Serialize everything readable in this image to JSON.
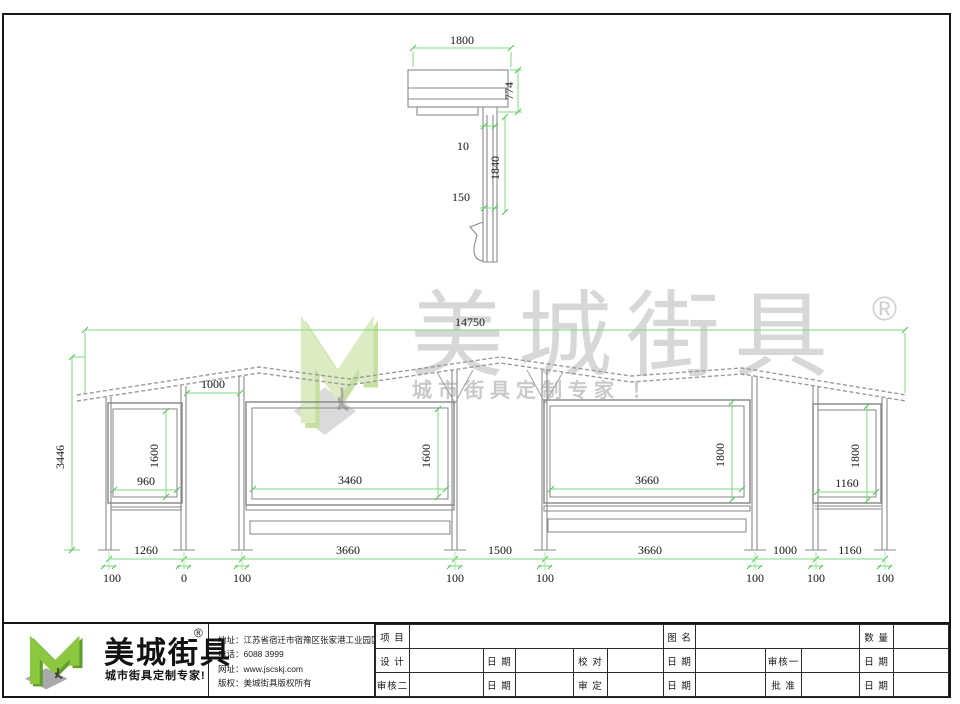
{
  "side_view": {
    "width": "1800",
    "roof_depth": "774",
    "gap": "10",
    "post_length": "1840",
    "offset": "150"
  },
  "elevation": {
    "total_width": "14750",
    "total_height": "3446",
    "roof_gap": "1000",
    "panel_a_width": "960",
    "panel_a_height": "1600",
    "panel_b_width": "3460",
    "panel_b_height": "1600",
    "panel_c_width": "3660",
    "panel_c_height": "1800",
    "panel_d_width": "1160",
    "panel_d_height": "1800",
    "spans": [
      "1260",
      "3660",
      "1500",
      "3660",
      "1000",
      "1160"
    ],
    "offsets": [
      "100",
      "0",
      "100",
      "100",
      "100",
      "100",
      "100",
      "100"
    ]
  },
  "watermark": {
    "brand": "美城街具",
    "reg": "®",
    "tagline": "城市街具定制专家 ！"
  },
  "footer": {
    "brand": "美城街具",
    "reg": "®",
    "tagline": "城市街具定制专家!",
    "contact": {
      "address": "地址：江苏省宿迁市宿豫区张家港工业园区南斗路西侧1号",
      "phone": "电话：6088 3999",
      "website": "网址：www.jscskj.com",
      "copyright": "版权：美城街具版权所有"
    },
    "titleblock": {
      "project": "项 目",
      "drawing_name": "图 名",
      "quantity": "数 量",
      "design": "设 计",
      "date": "日 期",
      "proofread": "校 对",
      "review1": "审核一",
      "review2": "审核二",
      "approve": "审 定",
      "ratify": "批 准"
    }
  },
  "colors": {
    "dimension_green": "#7fd97f",
    "drawing_gray": "#8f8f8f",
    "logo_green": "#8dc63f",
    "watermark_green": "#dcebc2"
  }
}
